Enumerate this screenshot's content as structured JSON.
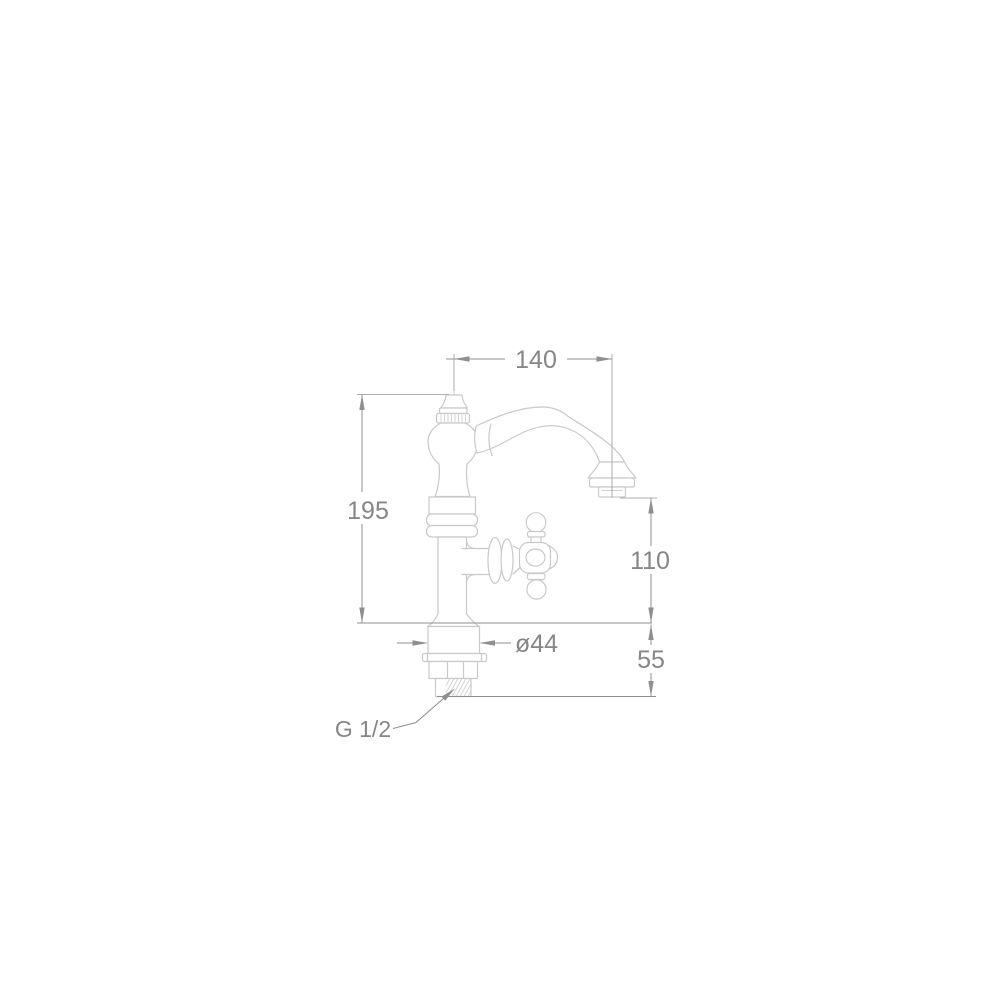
{
  "page": {
    "background": "#ffffff"
  },
  "drawing": {
    "type": "technical-dimension-drawing",
    "subject": "classic single-hole pillar tap with swan-neck spout and cross handle",
    "labels": {
      "spout_reach": "140",
      "total_height": "195",
      "outlet_height": "110",
      "base_diameter": "ø44",
      "under_counter_depth": "55",
      "thread_size": "G 1/2"
    },
    "colors": {
      "outline": "#c9c9c9",
      "dimension_lines": "#8f8f8f",
      "label_text": "#868686",
      "background": "#ffffff"
    }
  }
}
